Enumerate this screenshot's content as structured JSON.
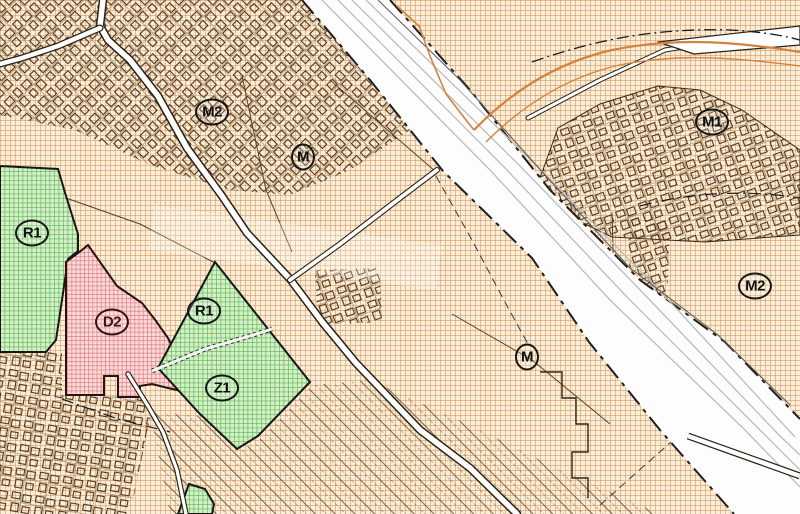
{
  "map": {
    "kind": "zoning-plan-map",
    "zones": [
      {
        "label": "M2",
        "badge_color": "#101010",
        "region_fill": "tan-hatch",
        "area": "northwest"
      },
      {
        "label": "M",
        "badge_color": "#101010",
        "region_fill": "tan-hatch",
        "area": "north-central"
      },
      {
        "label": "R1",
        "badge_color": "#101010",
        "region_fill": "green-hatch",
        "area": "west"
      },
      {
        "label": "D2",
        "badge_color": "#441111",
        "region_fill": "red-hatch",
        "area": "west-central"
      },
      {
        "label": "R1",
        "badge_color": "#101010",
        "region_fill": "green-hatch",
        "area": "central"
      },
      {
        "label": "Z1",
        "badge_color": "#101010",
        "region_fill": "green-hatch",
        "area": "south-central"
      },
      {
        "label": "M",
        "badge_color": "#101010",
        "region_fill": "tan-hatch",
        "area": "southeast-central"
      },
      {
        "label": "M1",
        "badge_color": "#101010",
        "region_fill": "tan-hatch",
        "area": "northeast"
      },
      {
        "label": "M2",
        "badge_color": "#101010",
        "region_fill": "tan-hatch",
        "area": "east"
      }
    ],
    "palette": {
      "background_cream": "#f8eed9",
      "hatch_orange": "#d28a4b",
      "green_zone_fill": "#d6f0c6",
      "green_zone_hatch": "#5cb55c",
      "red_zone_fill": "#f8dcdc",
      "red_zone_hatch": "#e47a7a",
      "magenta_parcel": "#cf6ecf",
      "road_white": "#ffffff",
      "line_dark": "#2a2014",
      "rail_gray": "#bcbcbc",
      "stream_orange": "#d4823e"
    }
  }
}
